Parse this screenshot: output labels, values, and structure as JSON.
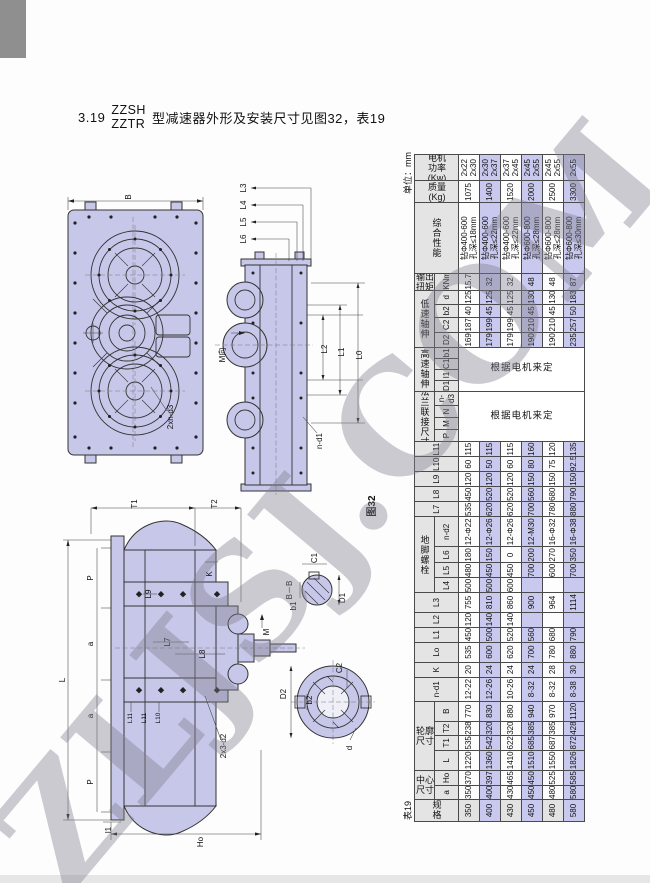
{
  "heading": {
    "number": "3.19",
    "model_top": "ZZSH",
    "model_bottom": "ZZTR",
    "text": "型减速器外形及安装尺寸见图32，表19"
  },
  "watermark": {
    "text": "ZLJSJ.COM"
  },
  "figures": {
    "caption": "图32",
    "plan": {
      "B": "B",
      "bolts": "2xn-d3"
    },
    "side": {
      "L3": "L3",
      "L4": "L4",
      "L5": "L5",
      "L6": "L6",
      "L2": "L2",
      "L1": "L1",
      "L0": "L0",
      "M_dir": "M向",
      "n_d1": "n-d1"
    },
    "front": {
      "T1": "T1",
      "T2": "T2",
      "P_top": "P",
      "a_top": "a",
      "a_bottom": "a",
      "P_bottom": "P",
      "L": "L",
      "L9": "L9",
      "L7": "L7",
      "L8": "L8",
      "K": "K",
      "M": "M",
      "holes": "2x3-d2",
      "L11a": "L11",
      "L11b": "L11",
      "L10": "L10",
      "Ho": "Ho",
      "l1": "l1"
    },
    "section_bb": {
      "title": "B－B",
      "C1": "C1",
      "b1": "b1",
      "D1": "D1"
    },
    "shaft_detail": {
      "C2": "C2",
      "D2": "D2",
      "b2": "b2",
      "d": "d"
    }
  },
  "table": {
    "caption": "表19",
    "unit": "单位：mm",
    "motor_note": "根据电机来定",
    "colors": {
      "highlight": "#c9c9ef",
      "header_bg": "#e4e4e4"
    },
    "highlight_rows": [
      1,
      3,
      5
    ],
    "columns": [
      {
        "key": "spec",
        "label": "规\n格",
        "cn": true,
        "w": 22
      },
      {
        "label": "中心\n尺寸",
        "cn": true,
        "subs": [
          {
            "key": "a",
            "label": "a",
            "w": 14
          },
          {
            "key": "Ho",
            "label": "Ho",
            "w": 15
          }
        ]
      },
      {
        "label": "轮廓\n尺寸",
        "cn": true,
        "subs": [
          {
            "key": "L",
            "label": "L",
            "w": 20
          },
          {
            "key": "T1",
            "label": "T1",
            "w": 15
          },
          {
            "key": "T2",
            "label": "T2",
            "w": 14
          },
          {
            "key": "B",
            "label": "B",
            "w": 20
          }
        ]
      },
      {
        "key": "nd1",
        "label": "n-d1",
        "w": 24
      },
      {
        "key": "K",
        "label": "K",
        "w": 15
      },
      {
        "key": "Lo",
        "label": "Lo",
        "w": 20
      },
      {
        "key": "L1",
        "label": "L1",
        "w": 15
      },
      {
        "key": "L2",
        "label": "L2",
        "w": 15
      },
      {
        "key": "L3",
        "label": "L3",
        "w": 19
      },
      {
        "label": "地\n脚\n螺\n栓",
        "cn": true,
        "subs": [
          {
            "key": "L4",
            "label": "L4",
            "w": 15
          },
          {
            "key": "L5",
            "label": "L5",
            "w": 15
          },
          {
            "key": "L6",
            "label": "L6",
            "w": 16
          },
          {
            "key": "nd2",
            "label": "n-d2",
            "w": 30
          }
        ]
      },
      {
        "key": "L7",
        "label": "L7",
        "w": 15
      },
      {
        "key": "L8",
        "label": "L8",
        "w": 15
      },
      {
        "key": "L9",
        "label": "L9",
        "w": 15
      },
      {
        "key": "L10",
        "label": "L10",
        "w": 15
      },
      {
        "key": "L11",
        "label": "L11",
        "w": 15
      },
      {
        "label": "法\n兰\n联\n接\n尺\n寸",
        "cn": true,
        "merged": true,
        "subs": [
          {
            "key": "P",
            "label": "P",
            "w": 12
          },
          {
            "key": "M",
            "label": "M",
            "w": 12
          },
          {
            "key": "N",
            "label": "N",
            "w": 12
          },
          {
            "key": "nd3",
            "label": "n-d3",
            "w": 14
          }
        ]
      },
      {
        "label": "高\n速\n轴\n伸",
        "cn": true,
        "merged": true,
        "subs": [
          {
            "key": "D1",
            "label": "D1",
            "w": 11
          },
          {
            "key": "l1",
            "label": "l1",
            "w": 11
          },
          {
            "key": "C1",
            "label": "C1",
            "w": 11
          },
          {
            "key": "b1",
            "label": "b1",
            "w": 11
          }
        ]
      },
      {
        "label": "低\n速\n轴\n伸",
        "cn": true,
        "subs": [
          {
            "key": "D2",
            "label": "D2",
            "w": 15
          },
          {
            "key": "C2",
            "label": "C2",
            "w": 15
          },
          {
            "key": "b2",
            "label": "b2",
            "w": 13
          },
          {
            "key": "d",
            "label": "d",
            "w": 14
          }
        ]
      },
      {
        "label": "输出\n扭矩",
        "cn": true,
        "subs": [
          {
            "key": "knm",
            "label": "KNm",
            "w": 17
          }
        ]
      },
      {
        "key": "perf",
        "label": "综\n合\n性\n能",
        "cn": true,
        "w": 70
      },
      {
        "key": "mass",
        "label": "质量\n(Kg)",
        "cn": true,
        "w": 22
      },
      {
        "key": "power",
        "label": "电机\n功率\n(Kw)",
        "cn": true,
        "w": 26
      }
    ],
    "rows": [
      {
        "spec": "350",
        "a": "350",
        "Ho": "370",
        "L": "1220",
        "T1": "535",
        "T2": "238",
        "B": "770",
        "nd1": "12-22",
        "K": "20",
        "Lo": "535",
        "L1": "450",
        "L2": "120",
        "L3": "755",
        "L4": "500",
        "L5": "480",
        "L6": "180",
        "nd2": "12-Φ22",
        "L7": "535",
        "L8": "450",
        "L9": "120",
        "L10": "60",
        "L11": "115",
        "D2": "169",
        "C2": "187",
        "b2": "40",
        "d": "125",
        "knm": "15.7",
        "perf": "钻Φ400-600\n孔深≤18mm",
        "mass": "1075",
        "power": "2x22\n2x30"
      },
      {
        "spec": "400",
        "a": "400",
        "Ho": "397",
        "L": "1360",
        "T1": "542",
        "T2": "320",
        "B": "830",
        "nd1": "12-26",
        "K": "24",
        "Lo": "600",
        "L1": "500",
        "L2": "140",
        "L3": "810",
        "L4": "500",
        "L5": "450",
        "L6": "150",
        "nd2": "12-Φ26",
        "L7": "620",
        "L8": "520",
        "L9": "120",
        "L10": "50",
        "L11": "115",
        "D2": "179",
        "C2": "199",
        "b2": "45",
        "d": "125",
        "knm": "32",
        "perf": "钻Φ400-600\n孔深≤22mm",
        "mass": "1400",
        "power": "2x30\n2x37"
      },
      {
        "spec": "430",
        "a": "430",
        "Ho": "465",
        "L": "1410",
        "T1": "622",
        "T2": "320",
        "B": "880",
        "nd1": "10-26",
        "K": "24",
        "Lo": "620",
        "L1": "520",
        "L2": "140",
        "L3": "860",
        "L4": "600",
        "L5": "450",
        "L6": "0",
        "nd2": "12-Φ26",
        "L7": "620",
        "L8": "520",
        "L9": "120",
        "L10": "60",
        "L11": "115",
        "D2": "179",
        "C2": "199",
        "b2": "45",
        "d": "125",
        "knm": "32",
        "perf": "钻Φ400-600\n孔深≤22mm",
        "mass": "1520",
        "power": "2x37\n2x45"
      },
      {
        "spec": "450",
        "a": "450",
        "Ho": "450",
        "L": "1510",
        "T1": "685",
        "T2": "385",
        "B": "940",
        "nd1": "8-32",
        "K": "24",
        "Lo": "700",
        "L1": "560",
        "L2": "",
        "L3": "900",
        "L4": "",
        "L5": "700",
        "L6": "200",
        "nd2": "12-M30",
        "L7": "700",
        "L8": "560",
        "L9": "150",
        "L10": "80",
        "L11": "160",
        "D2": "190",
        "C2": "210",
        "b2": "45",
        "d": "130",
        "knm": "48",
        "perf": "钻Φ600-800\n孔深≤28mm",
        "mass": "2000",
        "power": "2x45\n2x55"
      },
      {
        "spec": "480",
        "a": "480",
        "Ho": "525",
        "L": "1550",
        "T1": "687",
        "T2": "385",
        "B": "970",
        "nd1": "8-32",
        "K": "28",
        "Lo": "780",
        "L1": "680",
        "L2": "",
        "L3": "964",
        "L4": "",
        "L5": "600",
        "L6": "270",
        "nd2": "16-Φ32",
        "L7": "780",
        "L8": "680",
        "L9": "150",
        "L10": "75",
        "L11": "120",
        "D2": "190",
        "C2": "210",
        "b2": "45",
        "d": "130",
        "knm": "48",
        "perf": "钻Φ600-800\n孔深≤28mm",
        "mass": "2500",
        "power": "2x45\n2x55"
      },
      {
        "spec": "580",
        "a": "580",
        "Ho": "585",
        "L": "1826",
        "T1": "872",
        "T2": "428",
        "B": "1120",
        "nd1": "8-38",
        "K": "30",
        "Lo": "880",
        "L1": "790",
        "L2": "",
        "L3": "1114",
        "L4": "",
        "L5": "700",
        "L6": "350",
        "nd2": "16-Φ38",
        "L7": "880",
        "L8": "790",
        "L9": "150",
        "L10": "92.5",
        "L11": "135",
        "D2": "235",
        "C2": "257",
        "b2": "50",
        "d": "183",
        "knm": "87",
        "perf": "钻Φ600-800\n孔深≤30mm",
        "mass": "3300",
        "power": "2x55"
      }
    ]
  }
}
